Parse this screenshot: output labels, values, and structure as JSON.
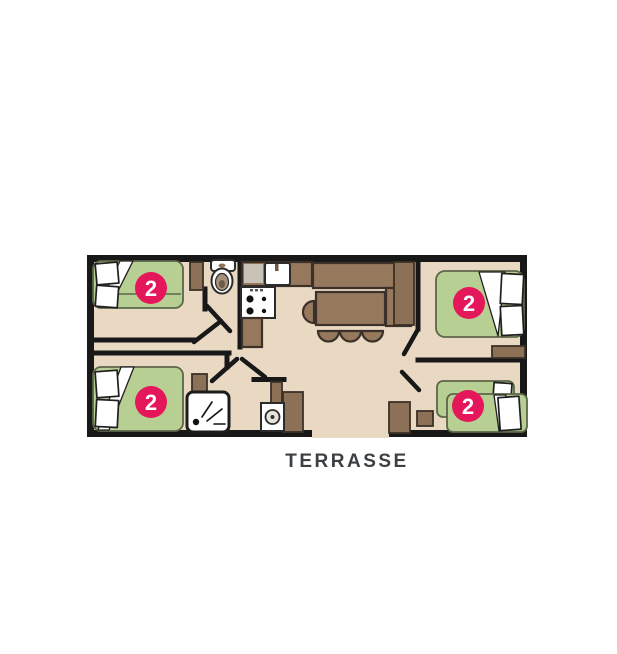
{
  "plan": {
    "terrace_label": "TERRASSE",
    "bedrooms": [
      {
        "name": "bedroom-top-left",
        "capacity": "2"
      },
      {
        "name": "bedroom-bottom-left",
        "capacity": "2"
      },
      {
        "name": "bedroom-top-right",
        "capacity": "2"
      },
      {
        "name": "bedroom-bottom-right",
        "capacity": "2"
      }
    ],
    "icons": [
      "toilet-icon",
      "kitchen-sink-icon",
      "stove-icon",
      "shower-icon",
      "washing-machine-icon",
      "dining-table-icon",
      "bench-sofa-icon",
      "stool-icon",
      "wardrobe-icon",
      "bed-icon",
      "pillow-icon"
    ],
    "colors": {
      "floor": "#e9d9c3",
      "wall": "#181818",
      "bed_green": "#b7cf92",
      "badge_pink": "#e5175b",
      "furniture_brown": "#96795d",
      "cabinet_brown": "#8d7157",
      "counter_gray": "#c9c2b8",
      "label_text": "#3d4043",
      "white": "#ffffff"
    }
  }
}
